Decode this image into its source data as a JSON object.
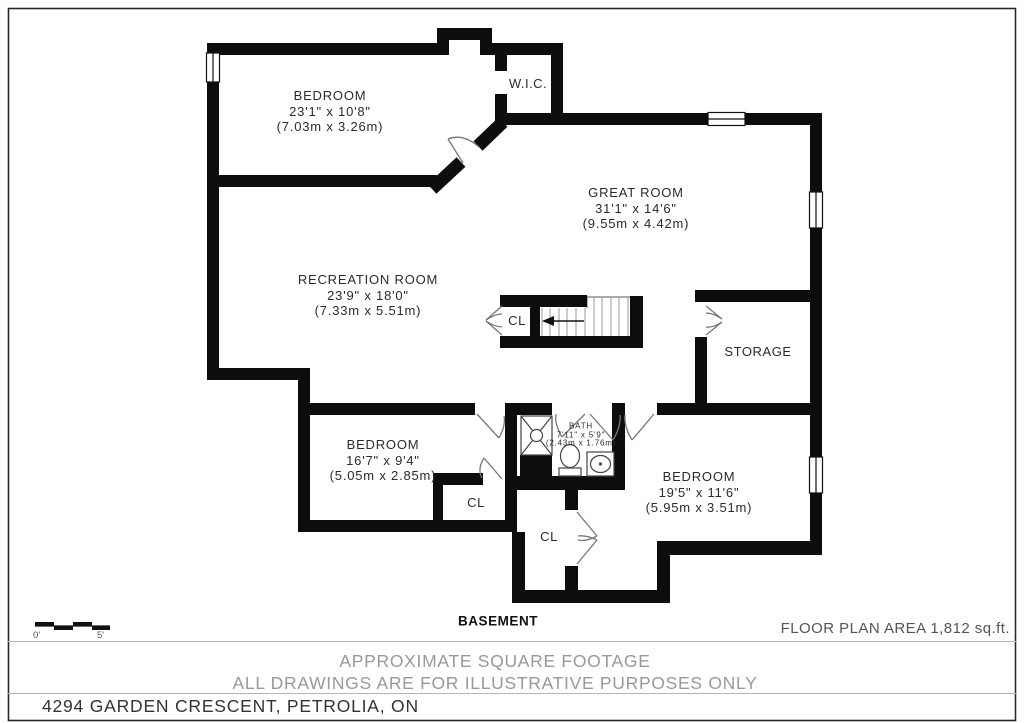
{
  "plan": {
    "level_label": "BASEMENT",
    "area_note": "FLOOR PLAN AREA 1,812 sq.ft.",
    "disclaimer_line1": "APPROXIMATE SQUARE FOOTAGE",
    "disclaimer_line2": "ALL DRAWINGS ARE FOR ILLUSTRATIVE PURPOSES ONLY",
    "address": "4294 GARDEN CRESCENT, PETROLIA, ON",
    "scale": {
      "start_label": "0'",
      "end_label": "5'"
    }
  },
  "rooms": [
    {
      "id": "bedroom-tl",
      "name": "BEDROOM",
      "dim_imperial": "23'1\" x 10'8\"",
      "dim_metric": "(7.03m x 3.26m)"
    },
    {
      "id": "wic",
      "name": "W.I.C."
    },
    {
      "id": "great-room",
      "name": "GREAT ROOM",
      "dim_imperial": "31'1\" x 14'6\"",
      "dim_metric": "(9.55m x 4.42m)"
    },
    {
      "id": "recreation-room",
      "name": "RECREATION ROOM",
      "dim_imperial": "23'9\" x 18'0\"",
      "dim_metric": "(7.33m x 5.51m)"
    },
    {
      "id": "storage",
      "name": "STORAGE"
    },
    {
      "id": "bedroom-bl",
      "name": "BEDROOM",
      "dim_imperial": "16'7\" x 9'4\"",
      "dim_metric": "(5.05m x 2.85m)"
    },
    {
      "id": "bath",
      "name": "BATH",
      "dim_imperial": "7'11\" x 5'9\"",
      "dim_metric": "(2.43m x 1.76m)"
    },
    {
      "id": "bedroom-br",
      "name": "BEDROOM",
      "dim_imperial": "19'5\" x 11'6\"",
      "dim_metric": "(5.95m x 3.51m)"
    },
    {
      "id": "closet-stairs",
      "name": "CL"
    },
    {
      "id": "closet-bl",
      "name": "CL"
    },
    {
      "id": "closet-hall",
      "name": "CL"
    }
  ],
  "colors": {
    "wall": "#0d0d0d",
    "text": "#2b2b2b",
    "muted": "#999999",
    "frame": "#2a2a2a"
  }
}
